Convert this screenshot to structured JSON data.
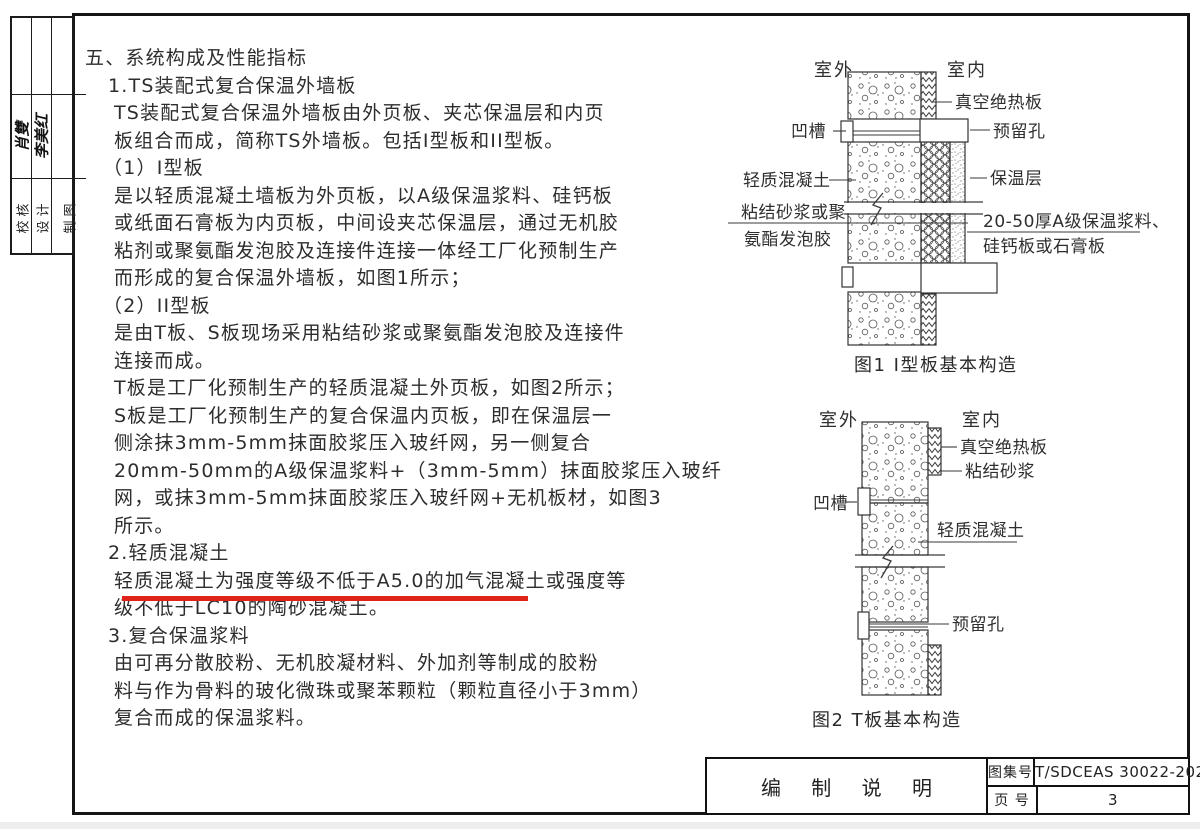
{
  "stamp_block": {
    "columns": [
      {
        "label": "校核",
        "signature": "肖雙"
      },
      {
        "label": "设计",
        "signature": "李美红"
      },
      {
        "label": "制图",
        "signature": ""
      }
    ]
  },
  "content": {
    "lines": [
      "五、系统构成及性能指标",
      "1.TS装配式复合保温外墙板",
      "TS装配式复合保温外墙板由外页板、夹芯保温层和内页",
      "板组合而成，简称TS外墙板。包括I型板和II型板。",
      "（1）I型板",
      "是以轻质混凝土墙板为外页板，以A级保温浆料、硅钙板",
      "或纸面石膏板为内页板，中间设夹芯保温层，通过无机胶",
      "粘剂或聚氨酯发泡胶及连接件连接一体经工厂化预制生产",
      "而形成的复合保温外墙板，如图1所示；",
      "（2）II型板",
      "是由T板、S板现场采用粘结砂浆或聚氨酯发泡胶及连接件",
      "连接而成。",
      "T板是工厂化预制生产的轻质混凝土外页板，如图2所示；",
      "S板是工厂化预制生产的复合保温内页板，即在保温层一",
      "侧涂抹3mm-5mm抹面胶浆压入玻纤网，另一侧复合",
      "20mm-50mm的A级保温浆料+（3mm-5mm）抹面胶浆压入玻纤",
      "网，或抹3mm-5mm抹面胶浆压入玻纤网+无机板材，如图3",
      "所示。",
      "2.轻质混凝土",
      "轻质混凝土为强度等级不低于A5.0的加气混凝土或强度等",
      "级不低于LC10的陶砂混凝土。",
      "3.复合保温浆料",
      "由可再分散胶粉、无机胶凝材料、外加剂等制成的胶粉",
      "料与作为骨料的玻化微珠或聚苯颗粒（颗粒直径小于3mm）",
      "复合而成的保温浆料。"
    ],
    "highlight_color": "#df2318"
  },
  "figure1": {
    "caption": "图1  I型板基本构造",
    "outside": "室外",
    "inside": "室内",
    "labels": {
      "vip": "真空绝热板",
      "hole": "预留孔",
      "insulation": "保温层",
      "mortar_line1": "20-50厚A级保温浆料、",
      "mortar_line2": "硅钙板或石膏板",
      "groove": "凹槽",
      "concrete": "轻质混凝土",
      "bond_line1": "粘结砂浆或聚",
      "bond_line2": "氨酯发泡胶"
    }
  },
  "figure2": {
    "caption": "图2  T板基本构造",
    "outside": "室外",
    "inside": "室内",
    "labels": {
      "vip": "真空绝热板",
      "mortar": "粘结砂浆",
      "groove": "凹槽",
      "concrete": "轻质混凝土",
      "hole": "预留孔"
    }
  },
  "title_block": {
    "name": "编 制 说 明",
    "atlas_label": "图集号",
    "atlas_value": "T/SDCEAS 30022-2025",
    "page_label": "页 号",
    "page_value": "3"
  }
}
